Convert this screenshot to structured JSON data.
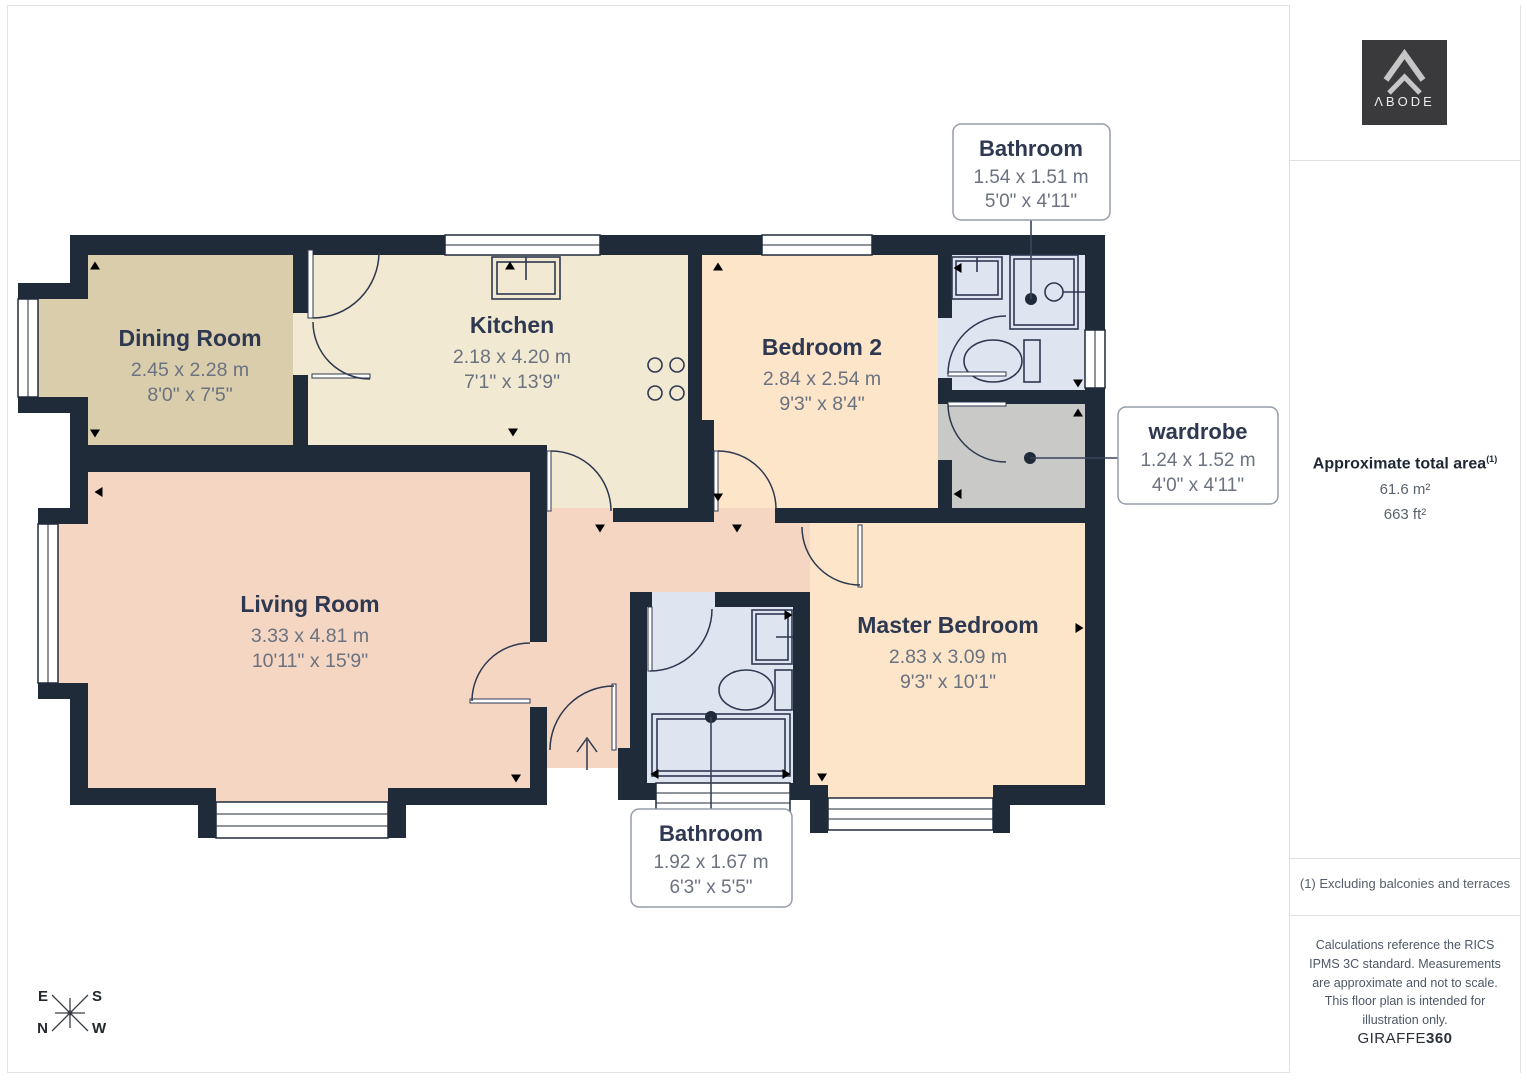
{
  "floorplan": {
    "rooms": [
      {
        "id": "dining-room",
        "name": "Dining Room",
        "metric": "2.45 x 2.28 m",
        "imperial": "8'0\" x 7'5\""
      },
      {
        "id": "kitchen",
        "name": "Kitchen",
        "metric": "2.18 x 4.20 m",
        "imperial": "7'1\" x 13'9\""
      },
      {
        "id": "bedroom-2",
        "name": "Bedroom 2",
        "metric": "2.84 x 2.54 m",
        "imperial": "9'3\" x 8'4\""
      },
      {
        "id": "living-room",
        "name": "Living Room",
        "metric": "3.33 x 4.81 m",
        "imperial": "10'11\" x 15'9\""
      },
      {
        "id": "master-bedroom",
        "name": "Master Bedroom",
        "metric": "2.83 x 3.09 m",
        "imperial": "9'3\" x 10'1\""
      }
    ],
    "callouts": [
      {
        "id": "bathroom-ensuite",
        "name": "Bathroom",
        "metric": "1.54 x 1.51 m",
        "imperial": "5'0\" x 4'11\""
      },
      {
        "id": "wardrobe",
        "name": "wardrobe",
        "metric": "1.24 x 1.52 m",
        "imperial": "4'0\" x 4'11\""
      },
      {
        "id": "bathroom-main",
        "name": "Bathroom",
        "metric": "1.92 x 1.67 m",
        "imperial": "6'3\" x 5'5\""
      }
    ],
    "compass": {
      "e": "E",
      "s": "S",
      "n": "N",
      "w": "W"
    }
  },
  "branding": {
    "logo_text": "ΛBODE",
    "brand": "GIRAFFE",
    "brand_suffix": "360"
  },
  "sidebar": {
    "area_title": "Approximate total area",
    "area_footnote_marker": "(1)",
    "area_metric": "61.6 m²",
    "area_imperial": "663 ft²",
    "footnote": "(1) Excluding balconies and terraces",
    "disclaimer": "Calculations reference the RICS IPMS 3C standard. Measurements are approximate and not to scale. This floor plan is intended for illustration only."
  },
  "colors": {
    "wall": "#202b3a",
    "dining": "#d9cdac",
    "kitchen": "#f1e9d1",
    "bedroom": "#fce5c9",
    "living": "#f5d6c3",
    "bath": "#dfe4f1",
    "wardrobe": "#c9c9c8",
    "room_name": "#2e3850",
    "room_dim": "#6b7280",
    "logo_bg": "#3a3a3c"
  }
}
